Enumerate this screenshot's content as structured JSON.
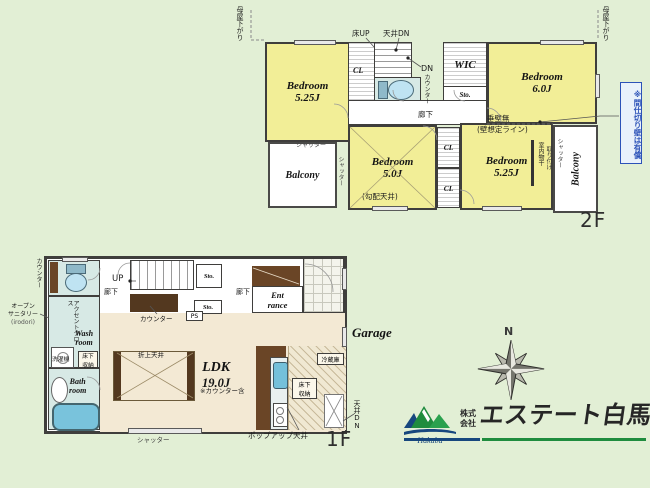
{
  "f2": {
    "floor_label": "2F",
    "moya_sagari": "母屋下がり",
    "yuka_up": "床UP",
    "tenjo_dn": "天井DN",
    "bedroom": "Bedroom",
    "size_nw": "5.25J",
    "size_ne": "6.0J",
    "size_sw": "5.0J",
    "size_se": "5.25J",
    "cl": "CL",
    "dn": "DN",
    "counter": "カウンター",
    "wic": "WIC",
    "sto": "Sto.",
    "hall": "廊下",
    "tarekabe": "垂壁無",
    "kabe_sotei": "(壁想定ライン)",
    "partition_note": "※間仕切り壁は有償",
    "shutter": "シャッター",
    "balcony": "Balcony",
    "kobai_tenjo": "(勾配天井)",
    "monohoshi": "室内物干",
    "monohoshi2": "取り付け"
  },
  "f1": {
    "floor_label": "1F",
    "counter": "カウンター",
    "os1": "オープン",
    "os2": "サニタリー",
    "os3": "(irodori)",
    "accent_cloth": "アクセントクロス",
    "wash1": "Wash",
    "wash2": "room",
    "washer": "洗濯機",
    "underfloor1": "床下",
    "underfloor2": "収納",
    "bath1": "Bath",
    "bath2": "room",
    "hall": "廊下",
    "up": "UP",
    "sto": "Sto.",
    "ps": "PS",
    "ent1": "Ent",
    "ent2": "rance",
    "oriage_tenjo": "折上天井",
    "ldk": "LDK",
    "ldk_size": "19.0J",
    "ldk_note": "※カウンター含",
    "fridge": "冷蔵庫",
    "garage": "Garage",
    "tenjo_dn": "天井DN",
    "popup_tenjo": "ポップアップ天井",
    "shutter": "シャッター"
  },
  "compass": {
    "north": "N"
  },
  "logo": {
    "prefix1": "株式",
    "prefix2": "会社",
    "name": "エステート白馬",
    "script": "Hakuba"
  },
  "colors": {
    "background": "#e2efd5",
    "room_yellow": "#f2ee97",
    "floor_beige": "#f3e9d4",
    "wet_room_cyan": "#d7e9e5",
    "wall": "#3f3e3c",
    "note_blue": "#2c52b8",
    "logo_green": "#1f8c3e",
    "logo_navy": "#17477e"
  }
}
